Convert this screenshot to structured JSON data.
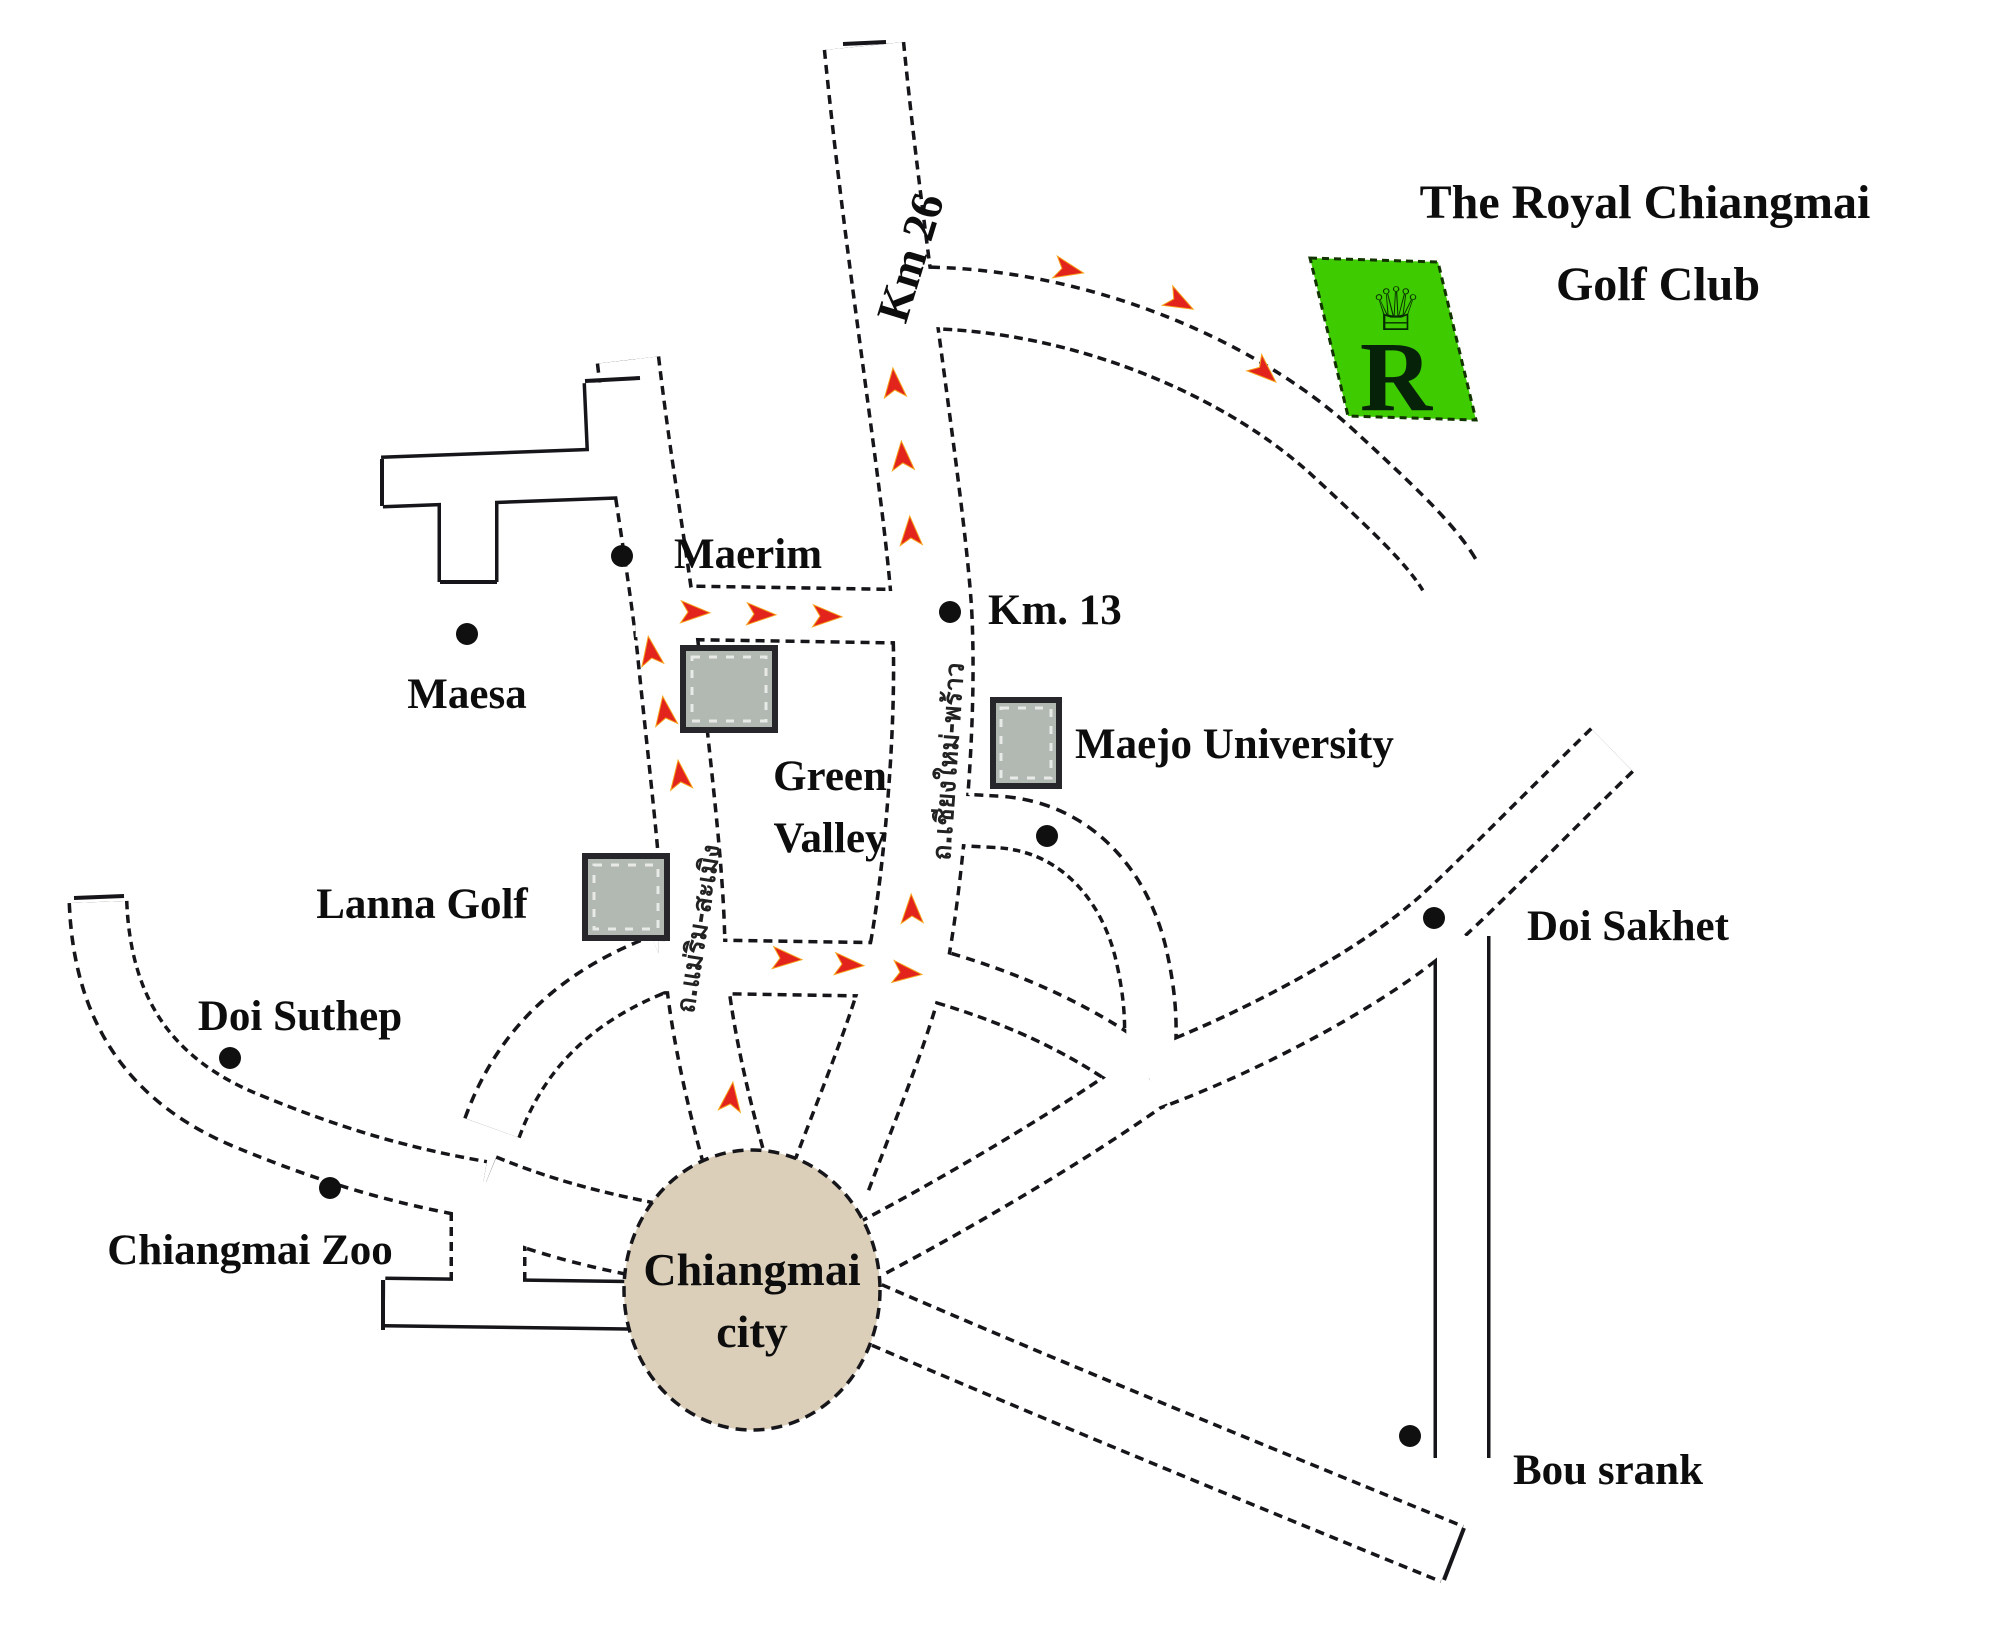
{
  "title": {
    "line1": "The Royal Chiangmai",
    "line2": "Golf Club"
  },
  "logo": {
    "letter": "R",
    "crown_glyph": "♕",
    "green": "#3ecb00"
  },
  "city_circle": {
    "line1": "Chiangmai",
    "line2": "city",
    "fill": "#dccfba"
  },
  "road_labels": {
    "km26": "Km 26",
    "chiangmai_phrao_thai": "ถ.เชียงใหม่-พร้าว",
    "maerim_samoeng_thai": "ถ.แม่ริม-สะเมิง"
  },
  "places": {
    "maerim": {
      "label": "Maerim"
    },
    "maesa": {
      "label": "Maesa"
    },
    "km13": {
      "label": "Km. 13"
    },
    "green_valley": {
      "line1": "Green",
      "line2": "Valley"
    },
    "maejo_university": {
      "label": "Maejo University"
    },
    "lanna_golf": {
      "label": "Lanna Golf"
    },
    "doi_suthep": {
      "label": "Doi Suthep"
    },
    "chiangmai_zoo": {
      "label": "Chiangmai Zoo"
    },
    "doi_sakhet": {
      "label": "Doi Sakhet"
    },
    "bou_srank": {
      "label": "Bou srank"
    }
  },
  "legend": {
    "route_arrow_color": "#e3241d",
    "road_outline_color": "#15151a",
    "poi_square_fill": "#b2b8b2"
  }
}
